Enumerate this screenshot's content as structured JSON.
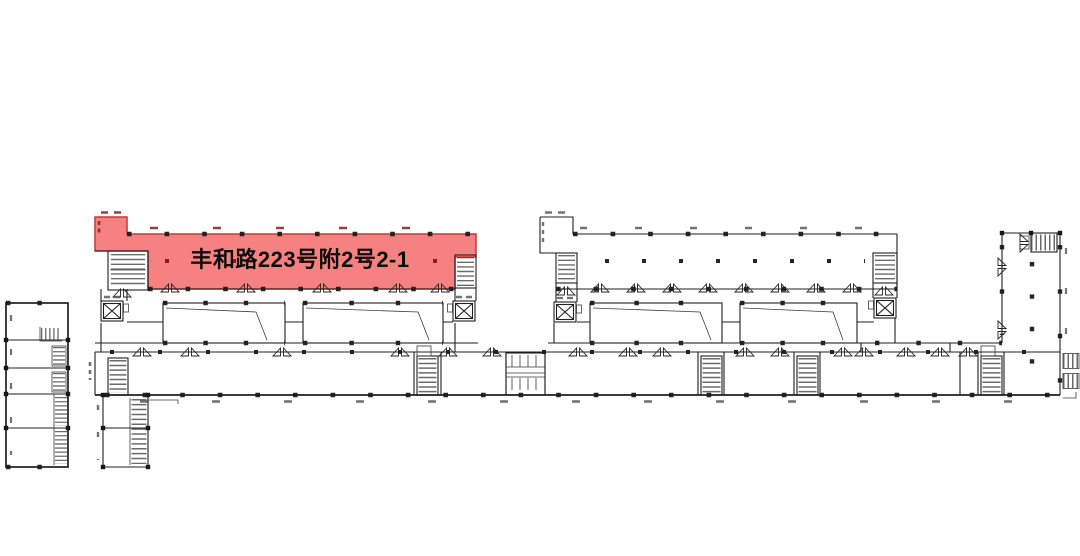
{
  "plan": {
    "unit_label": "丰和路223号附2号2-1",
    "colors": {
      "background": "#ffffff",
      "line": "#1a1a1a",
      "highlight_fill": "#f58280",
      "highlight_border": "#c23a38",
      "highlight_dot": "#8b1d1d"
    },
    "icons": {
      "stair_icon": "hatched-tread-strip",
      "elevator_icon": "box-with-x",
      "door_swing_icon": "double-triangle-bowtie",
      "column_dot": "small-black-square",
      "toilet_block": "stall-grid"
    }
  }
}
